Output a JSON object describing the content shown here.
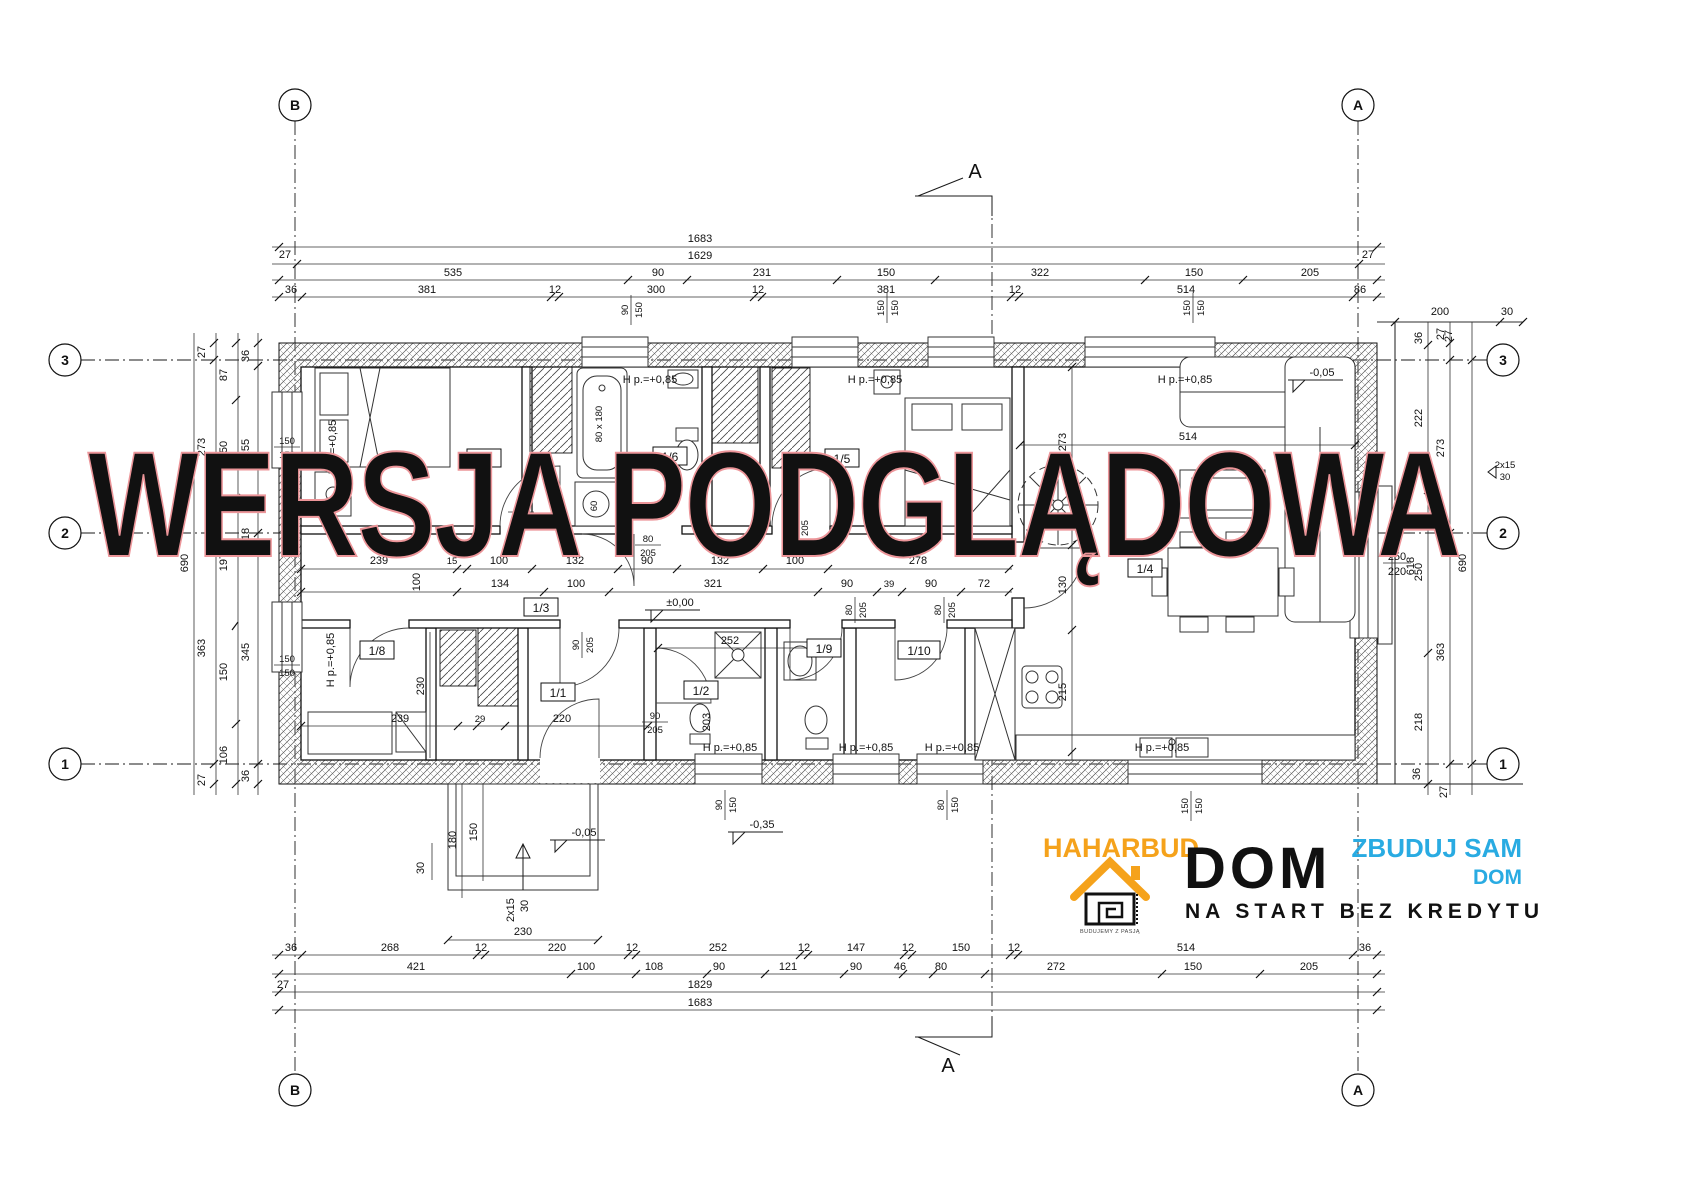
{
  "axes": {
    "b": "B",
    "a": "A",
    "n3": "3",
    "n2": "2",
    "n1": "1"
  },
  "section": {
    "label": "A"
  },
  "watermark": {
    "text": "WERSJA PODGLĄDOWA",
    "color": "#F3AFB2"
  },
  "levels": {
    "zero": "±0,00",
    "m005": "-0,05",
    "m035": "-0,35"
  },
  "sill": "H p.=+0,85",
  "rooms": {
    "r1": "1/1",
    "r2": "1/2",
    "r3": "1/3",
    "r4": "1/4",
    "r5": "1/5",
    "r6": "1/6",
    "r7": "1/7",
    "r8": "1/8",
    "r9": "1/9",
    "r10": "1/10"
  },
  "top": {
    "total1": "1683",
    "total2": "1629",
    "row3": [
      "535",
      "90",
      "231",
      "150",
      "322",
      "150",
      "205"
    ],
    "row4": [
      "36",
      "381",
      "12",
      "300",
      "12",
      "381",
      "12",
      "514",
      "86"
    ],
    "m27l": "27",
    "m27r": "27",
    "right_chain": [
      "200",
      "30",
      "27"
    ]
  },
  "bottom": {
    "row1": [
      "36",
      "268",
      "12",
      "220",
      "12",
      "252",
      "12",
      "147",
      "12",
      "150",
      "12",
      "514",
      "36"
    ],
    "row2": [
      "421",
      "100",
      "108",
      "90",
      "121",
      "90",
      "46",
      "80",
      "272",
      "150",
      "205"
    ],
    "total3": "1829",
    "total4": "1683",
    "m27": "27",
    "porch": "230"
  },
  "left": {
    "col0": "690",
    "col1": [
      "27",
      "273",
      "363",
      "27"
    ],
    "col2": [
      "87",
      "150",
      "197",
      "150",
      "106"
    ],
    "col3": [
      "36",
      "255",
      "18",
      "345",
      "36"
    ]
  },
  "right": {
    "colA": [
      "36",
      "222",
      "250",
      "218"
    ],
    "colB": [
      "27",
      "273",
      "363"
    ],
    "col0": "690",
    "corner": [
      "36",
      "27"
    ],
    "steps": [
      "2x15",
      "30"
    ],
    "h618": "618"
  },
  "fractions": {
    "lw1": [
      "150",
      "150"
    ],
    "lw2": [
      "150",
      "150"
    ],
    "tw1": [
      "90",
      "150"
    ],
    "tw2": [
      "150",
      "150"
    ],
    "tw3": [
      "150",
      "150"
    ],
    "bw1": [
      "90",
      "150"
    ],
    "bw2": [
      "80",
      "150"
    ],
    "bw3": [
      "150",
      "150"
    ],
    "d17": [
      "90",
      "205"
    ],
    "d16": [
      "80",
      "205"
    ],
    "d15": [
      "90",
      "205"
    ],
    "d11": [
      "90",
      "205"
    ],
    "d19": [
      "80",
      "205"
    ],
    "d110": [
      "80",
      "205"
    ],
    "entry": [
      "90",
      "205"
    ],
    "rdoor": [
      "250",
      "220"
    ]
  },
  "interior": {
    "corr1": [
      "239",
      "15",
      "100",
      "132",
      "90",
      "132",
      "100",
      "278"
    ],
    "corr2": [
      "134",
      "100",
      "321",
      "90",
      "39",
      "90",
      "72"
    ],
    "corr_100": "100",
    "r18": [
      "239",
      "29",
      "220"
    ],
    "r18_230": "230",
    "r12_252": "252",
    "r12_203": "203",
    "stair_273": "273",
    "stair_130": "130",
    "kitchen_215": "215",
    "living_514": "514",
    "tub": "80 x 180",
    "washer": "60",
    "porch": {
      "d180": "180",
      "d150": "150",
      "d30": "30",
      "steps": [
        "2x15",
        "30"
      ]
    }
  },
  "logo": {
    "brand": "HAHARBUD",
    "dom": "DOM",
    "blue1": "ZBUDUJ SAM",
    "blue2": "DOM",
    "tagline": "NA START BEZ KREDYTU",
    "caption": "BUDUJEMY Z PASJĄ",
    "orange": "#F5A21B",
    "blue": "#29ABE2"
  }
}
